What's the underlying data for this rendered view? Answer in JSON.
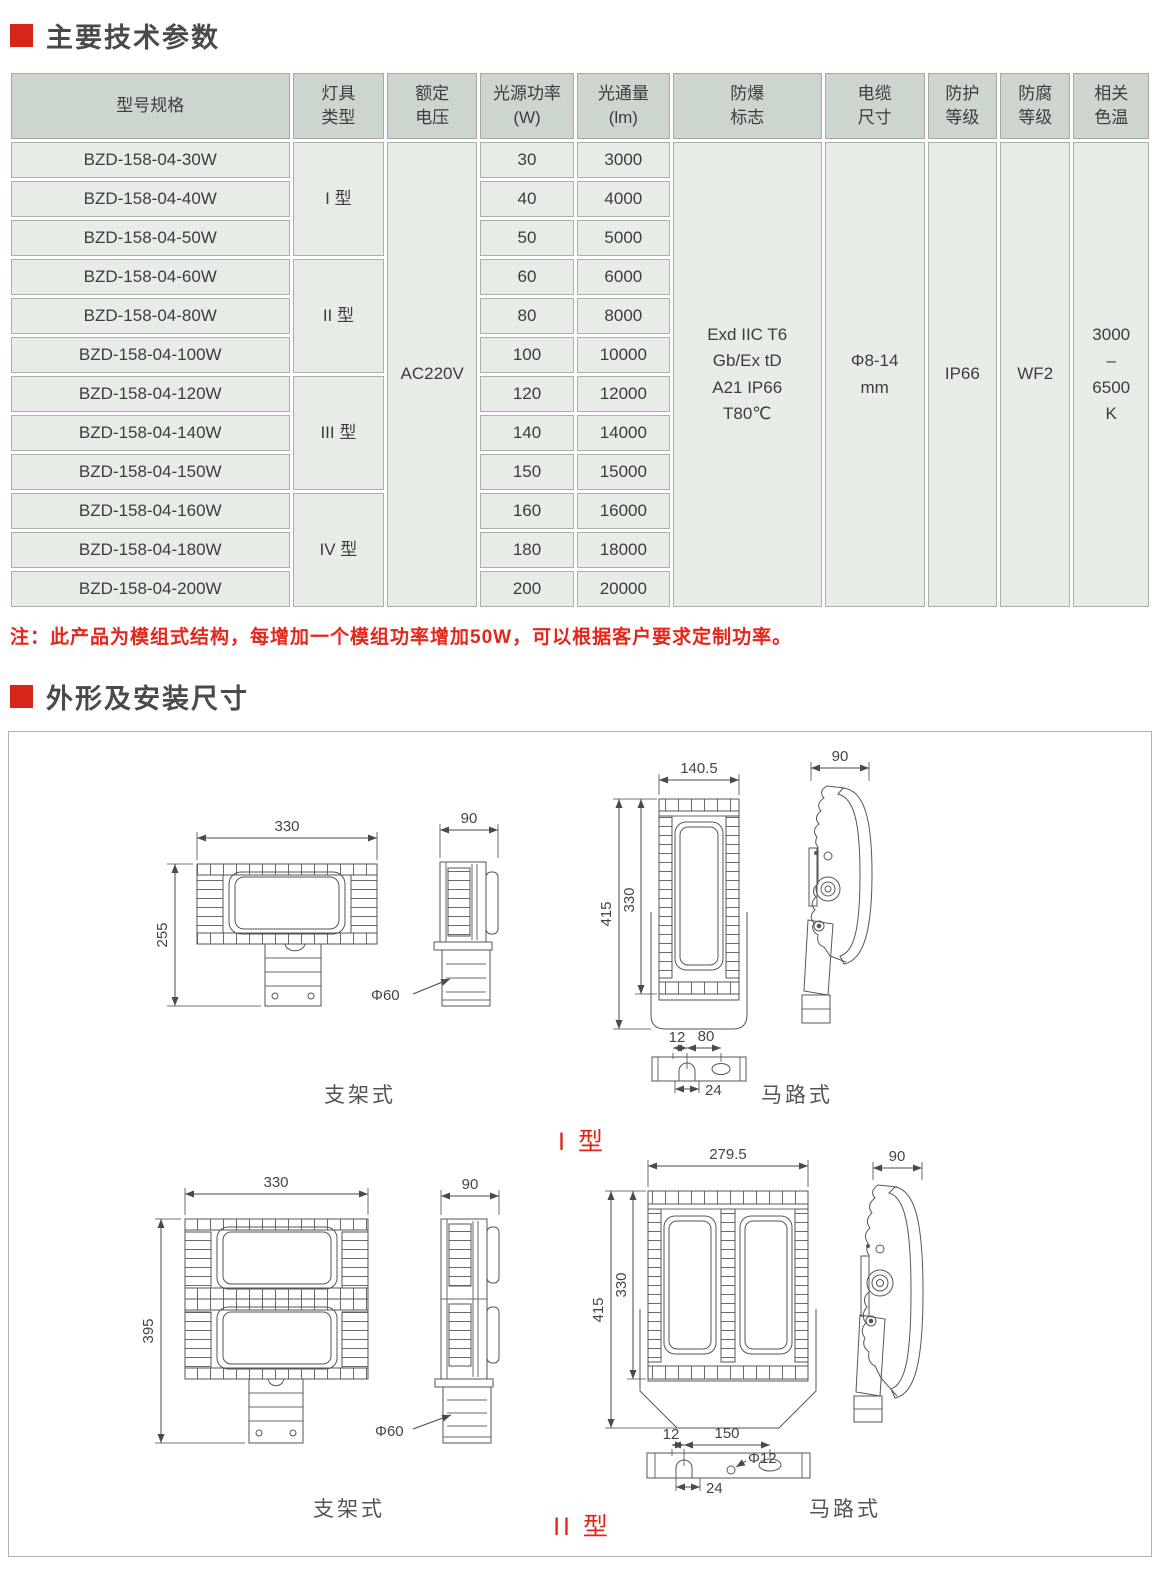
{
  "sections": {
    "params_title": "主要技术参数",
    "dims_title": "外形及安装尺寸"
  },
  "note": "注：此产品为模组式结构，每增加一个模组功率增加50W，可以根据客户要求定制功率。",
  "colors": {
    "accent_red": "#d8251c",
    "note_red": "#e5261a",
    "table_header_bg": "#cdd6ce",
    "table_row_bg": "#e7ece7"
  },
  "table": {
    "headers": [
      "型号规格",
      "灯具\n类型",
      "额定\n电压",
      "光源功率\n(W)",
      "光通量\n(lm)",
      "防爆\n标志",
      "电缆\n尺寸",
      "防护\n等级",
      "防腐\n等级",
      "相关\n色温"
    ],
    "type_groups": [
      "I 型",
      "II 型",
      "III 型",
      "IV 型"
    ],
    "voltage": "AC220V",
    "ex_mark": "Exd IIC T6\nGb/Ex tD\nA21 IP66\nT80℃",
    "cable_size": "Φ8-14\nmm",
    "protection": "IP66",
    "anticorrosion": "WF2",
    "cct": "3000\n–\n6500\nK",
    "rows": [
      {
        "model": "BZD-158-04-30W",
        "power": "30",
        "flux": "3000"
      },
      {
        "model": "BZD-158-04-40W",
        "power": "40",
        "flux": "4000"
      },
      {
        "model": "BZD-158-04-50W",
        "power": "50",
        "flux": "5000"
      },
      {
        "model": "BZD-158-04-60W",
        "power": "60",
        "flux": "6000"
      },
      {
        "model": "BZD-158-04-80W",
        "power": "80",
        "flux": "8000"
      },
      {
        "model": "BZD-158-04-100W",
        "power": "100",
        "flux": "10000"
      },
      {
        "model": "BZD-158-04-120W",
        "power": "120",
        "flux": "12000"
      },
      {
        "model": "BZD-158-04-140W",
        "power": "140",
        "flux": "14000"
      },
      {
        "model": "BZD-158-04-150W",
        "power": "150",
        "flux": "15000"
      },
      {
        "model": "BZD-158-04-160W",
        "power": "160",
        "flux": "16000"
      },
      {
        "model": "BZD-158-04-180W",
        "power": "180",
        "flux": "18000"
      },
      {
        "model": "BZD-158-04-200W",
        "power": "200",
        "flux": "20000"
      }
    ]
  },
  "d": {
    "t1": {
      "group_label": "I 型",
      "bracket_caption": "支架式",
      "road_caption": "马路式",
      "front_w": "330",
      "front_h": "255",
      "side_w": "90",
      "pole_d": "Φ60",
      "road_w": "140.5",
      "road_h_total": "415",
      "road_h_body": "330",
      "road_side_w": "90",
      "plate_a": "12",
      "plate_b": "80",
      "plate_c": "24"
    },
    "t2": {
      "group_label": "II 型",
      "bracket_caption": "支架式",
      "road_caption": "马路式",
      "front_w": "330",
      "front_h": "395",
      "side_w": "90",
      "pole_d": "Φ60",
      "road_w": "279.5",
      "road_h_total": "415",
      "road_h_body": "330",
      "road_side_w": "90",
      "plate_a": "12",
      "plate_b": "150",
      "plate_hole": "Φ12",
      "plate_c": "24"
    }
  }
}
